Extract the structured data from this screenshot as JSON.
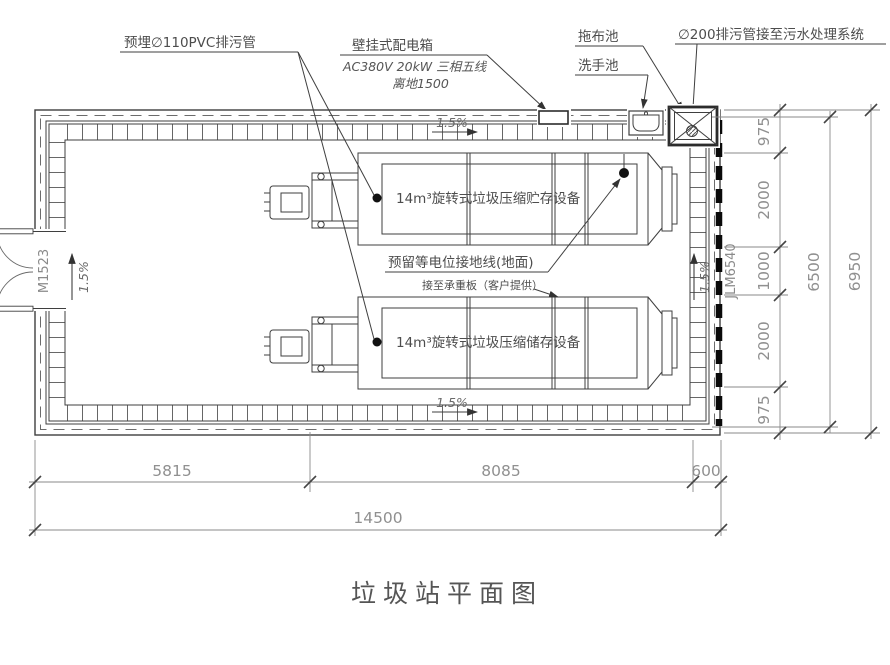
{
  "title": "垃圾站平面图",
  "callouts": {
    "buried_pipe": "预埋∅110PVC排污管",
    "power_box_title": "壁挂式配电箱",
    "power_box_spec": "AC380V 20kW 三相五线",
    "power_box_height": "离地1500",
    "mop_pool": "拖布池",
    "wash_sink": "洗手池",
    "drain_pipe": "∅200排污管接至污水处理系统",
    "equipment_upper": "14m³旋转式垃圾压缩贮存设备",
    "equipment_lower": "14m³旋转式垃圾压缩储存设备",
    "ground_wire": "预留等电位接地线(地面)",
    "bearing_plate": "接至承重板（客户提供）"
  },
  "marks": {
    "door_left": "M1523",
    "door_right": "JLM6540",
    "slope_top": "1.5%",
    "slope_bottom": "1.5%",
    "slope_left": "1.5%",
    "slope_right": "1.5%"
  },
  "dimensions": {
    "bottom_segments": [
      "5815",
      "8085",
      "600"
    ],
    "bottom_total": "14500",
    "right_segments": [
      "975",
      "2000",
      "1000",
      "2000",
      "975"
    ],
    "right_overall_inner": "6500",
    "right_overall": "6950"
  },
  "colors": {
    "line": "#3f3f3f",
    "dim_line": "#777777",
    "dim_text": "#909090",
    "label_text": "#4d4d4d",
    "shutter_door": "#0a0a0a"
  }
}
